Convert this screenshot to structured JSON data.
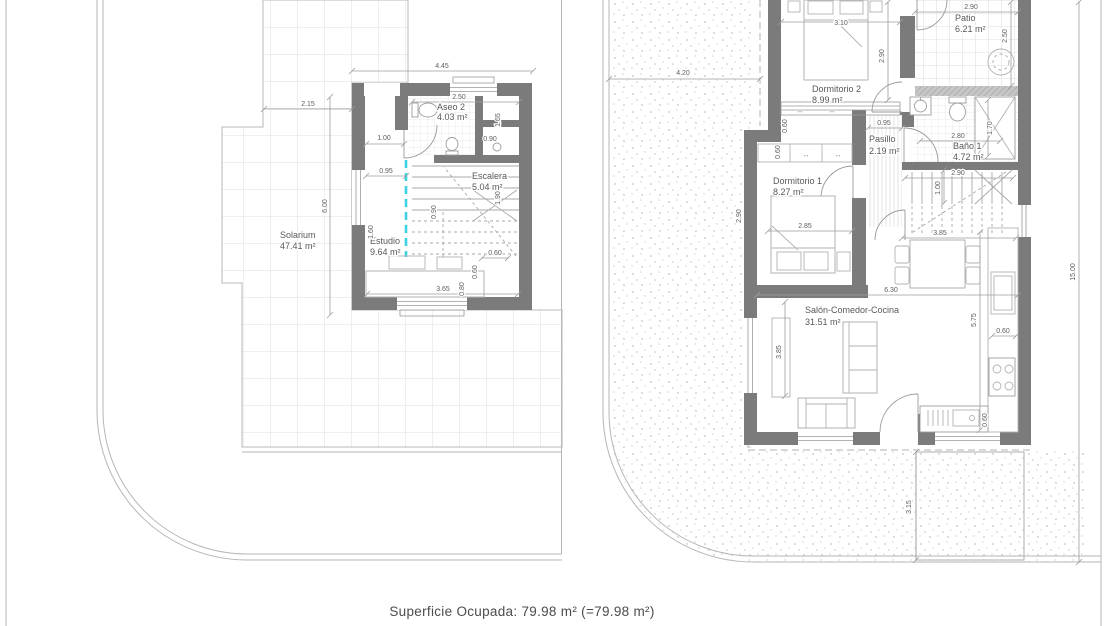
{
  "footer": {
    "superficie_ocupada": "Superficie Ocupada: 79.98 m² (=79.98 m²)"
  },
  "icons": {
    "window_arrow": "↔"
  },
  "colors": {
    "wall": "#7b7b7b",
    "section_marker": "#3ed1e2",
    "dimension_line": "#9c9c9c",
    "text": "#585858"
  },
  "left_plan": {
    "rooms": {
      "solarium": {
        "name": "Solarium",
        "area": "47.41 m²"
      },
      "aseo2": {
        "name": "Aseo 2",
        "area": "4.03 m²"
      },
      "escalera": {
        "name": "Escalera",
        "area": "5.04 m²"
      },
      "estudio": {
        "name": "Estudio",
        "area": "9.64 m²"
      }
    },
    "dims": {
      "top_width": "4.45",
      "solarium_offset": "2.15",
      "solarium_height": "6.00",
      "aseo_width": "2.50",
      "door_width": "1.00",
      "entry_width": "0.95",
      "closet_height": "1.65",
      "closet_width": "0.90",
      "stair_width": "0.90",
      "stair_height": "1.90",
      "estudio_height": "1.60",
      "estudio_width": "3.65",
      "desk_depth": "0.80",
      "d060a": "0.60",
      "d060b": "0.60"
    }
  },
  "right_plan": {
    "rooms": {
      "dormitorio2": {
        "name": "Dormitorio 2",
        "area": "8.99 m²"
      },
      "patio": {
        "name": "Patio",
        "area": "6.21 m²"
      },
      "pasillo": {
        "name": "Pasillo",
        "area": "2.19 m²"
      },
      "bano1": {
        "name": "Baño 1",
        "area": "4.72 m²"
      },
      "dormitorio1": {
        "name": "Dormitorio 1",
        "area": "8.27 m²"
      },
      "salon": {
        "name": "Salón-Comedor-Cocina",
        "area": "31.51 m²"
      }
    },
    "dims": {
      "site_left": "4.20",
      "site_right": "15.00",
      "site_bottom": "3.15",
      "dorm2_width": "3.10",
      "dorm2_height": "2.90",
      "patio_width": "2.90",
      "patio_height": "2.50",
      "pasillo_width": "0.95",
      "bano_width": "2.80",
      "bano_height": "1.70",
      "stair_width": "2.90",
      "stair_depth": "1.00",
      "dorm1_width": "2.85",
      "dorm1_height": "2.90",
      "wardrobe_a": "0.60",
      "wardrobe_b": "0.60",
      "salon_width": "6.30",
      "salon_height": "3.85",
      "dining_width": "3.85",
      "kitchen_height": "5.75",
      "kitchen_depth_a": "0.60",
      "kitchen_depth_b": "0.60"
    }
  }
}
